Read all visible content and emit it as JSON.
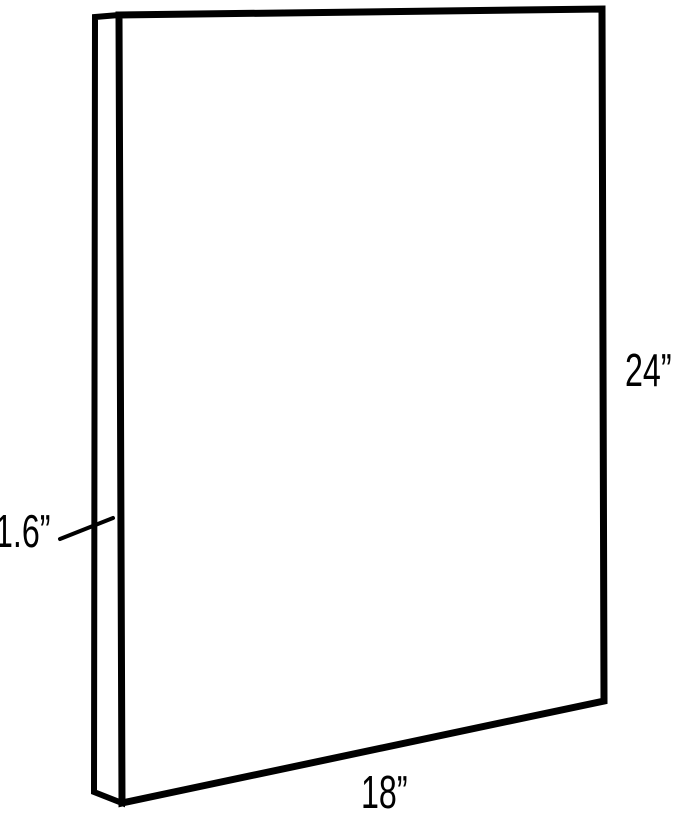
{
  "diagram": {
    "title": "panel-dimensions-diagram",
    "subject": "thin rectangular panel shown in three-quarter outline view",
    "labels": {
      "height": "24”",
      "width": "18”",
      "depth": "1.6”"
    },
    "colors": {
      "line": "#000000",
      "text": "#000000",
      "background": "#ffffff"
    }
  }
}
